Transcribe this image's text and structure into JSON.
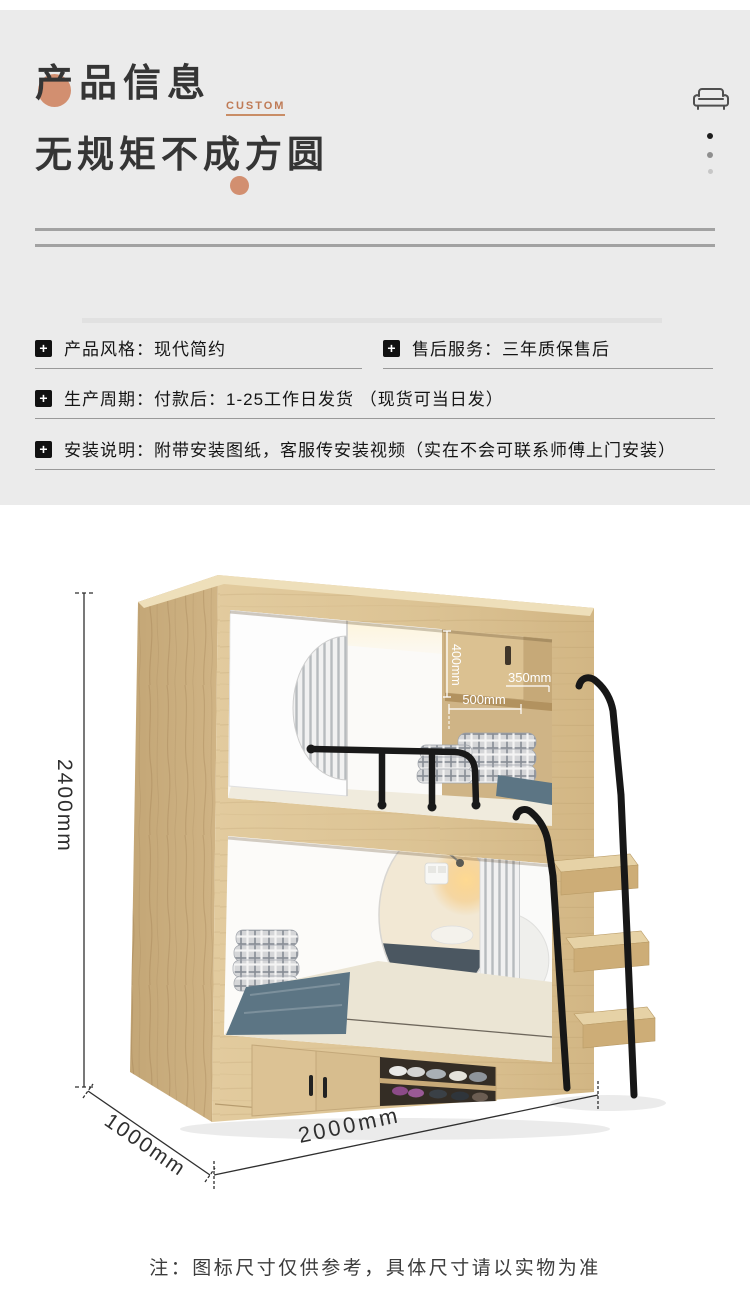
{
  "header": {
    "title": "产品信息",
    "badge": "CUSTOM",
    "subtitle": "无规矩不成方圆",
    "accent_color": "#d28f70",
    "icon": "sofa-icon"
  },
  "specs": {
    "bullet_glyph": "+",
    "rows": [
      {
        "text": "产品风格：现代简约"
      },
      {
        "text": "售后服务：三年质保售后"
      },
      {
        "text": "生产周期：付款后：1-25工作日发货 （现货可当日发）"
      },
      {
        "text": "安装说明：附带安装图纸，客服传安装视频（实在不会可联系师傅上门安装）"
      }
    ]
  },
  "diagram": {
    "overall": {
      "height": "2400mm",
      "depth": "1000mm",
      "width": "2000mm"
    },
    "cabinet": {
      "height": "400mm",
      "depth": "350mm",
      "width": "500mm"
    },
    "note": "注：图标尺寸仅供参考，具体尺寸请以实物为准",
    "colors": {
      "wood": "#dcc394",
      "metal": "#1a1a1a",
      "blanket": "#5c7584",
      "accent": "#d28f70"
    }
  }
}
